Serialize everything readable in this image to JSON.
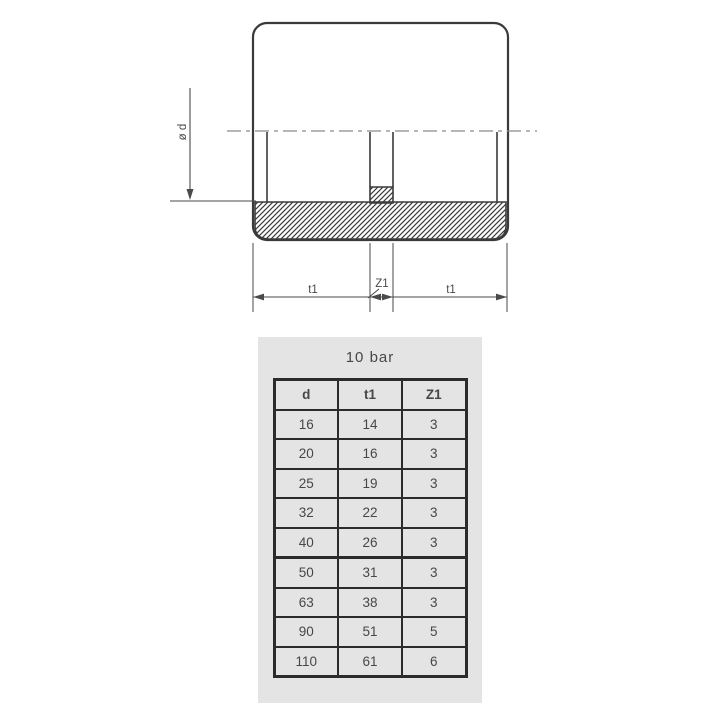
{
  "drawing": {
    "dim_diameter": "ø d",
    "dim_t1_left": "t1",
    "dim_z1": "Z1",
    "dim_t1_right": "t1"
  },
  "table": {
    "title": "10 bar",
    "columns": [
      "d",
      "t1",
      "Z1"
    ],
    "rows": [
      [
        "16",
        "14",
        "3"
      ],
      [
        "20",
        "16",
        "3"
      ],
      [
        "25",
        "19",
        "3"
      ],
      [
        "32",
        "22",
        "3"
      ],
      [
        "40",
        "26",
        "3"
      ],
      [
        "50",
        "31",
        "3"
      ],
      [
        "63",
        "38",
        "3"
      ],
      [
        "90",
        "51",
        "5"
      ],
      [
        "110",
        "61",
        "6"
      ]
    ]
  },
  "colors": {
    "outline": "#3a3a3a",
    "centerline": "#8a8a8a",
    "dim": "#4a4a4a",
    "panel": "#e4e4e4",
    "border": "#2b2b2b",
    "text": "#474747"
  }
}
